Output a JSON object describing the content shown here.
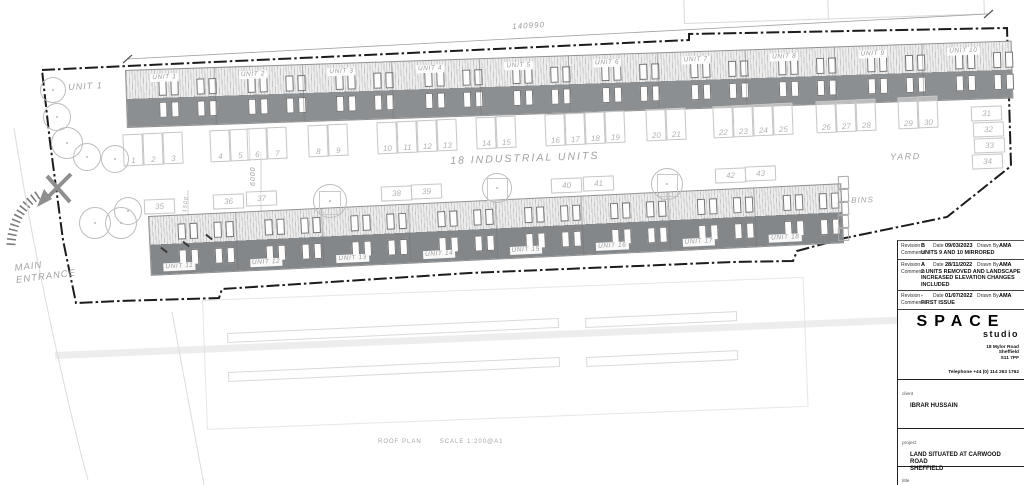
{
  "plan": {
    "overall_dimension": "140990",
    "road_dimension": "6000",
    "walkway_dimension": "1500",
    "area_label": "18 INDUSTRIAL UNITS",
    "unit1_area_label": "UNIT 1",
    "yard_label": "YARD",
    "bins_label": "BINS",
    "main_entrance_label": "MAIN\nENTRANCE",
    "caption": {
      "name": "ROOF PLAN",
      "scale": "SCALE 1:200@A1"
    },
    "top_row_units": [
      "UNIT 1",
      "UNIT 2",
      "UNIT 3",
      "UNIT 4",
      "UNIT 5",
      "UNIT 6",
      "UNIT 7",
      "UNIT 8",
      "UNIT 9",
      "UNIT 10"
    ],
    "bottom_row_units": [
      "UNIT 11",
      "UNIT 12",
      "UNIT 13",
      "UNIT 14",
      "UNIT 15",
      "UNIT 16",
      "UNIT 17",
      "UNIT 18"
    ],
    "parking_numbers_top": [
      "1",
      "2",
      "3",
      "4",
      "5",
      "6",
      "7",
      "8",
      "9",
      "10",
      "11",
      "12",
      "13",
      "14",
      "15",
      "16",
      "17",
      "18",
      "19",
      "20",
      "21",
      "22",
      "23",
      "24",
      "25",
      "26",
      "27",
      "28",
      "29",
      "30"
    ],
    "parking_numbers_side": [
      "31",
      "32",
      "33",
      "34"
    ],
    "parking_numbers_bottom": [
      "35",
      "36",
      "37",
      "38",
      "39",
      "40",
      "41",
      "42",
      "43"
    ]
  },
  "title_block": {
    "labels": {
      "revision": "Revision",
      "date": "Date",
      "drawn_by": "Drawn By",
      "comments": "Comments",
      "client": "client",
      "project": "project",
      "title": "title"
    },
    "revisions": [
      {
        "revision": "B",
        "date": "09/03/2023",
        "drawn_by": "AMA",
        "comments": "UNITS 9 AND 10 MIRRORED"
      },
      {
        "revision": "A",
        "date": "28/11/2022",
        "drawn_by": "AMA",
        "comments": "2 UNITS REMOVED AND LANDSCAPE\nINCREASED ELEVATION CHANGES INCLUDED"
      },
      {
        "revision": "-",
        "date": "01/07/2022",
        "drawn_by": "AMA",
        "comments": "FIRST ISSUE"
      }
    ],
    "studio": {
      "name": "SPACE",
      "subname": "studio",
      "address": "18 Mylor Road\nSheffield\nS11 7PF",
      "telephone": "Telephone +44 (0) 114 263 1762"
    },
    "client": "IBRAR HUSSAIN",
    "project": "LAND SITUATED AT CARWOOD ROAD\nSHEFFIELD",
    "drawing_title": "PROPOSED ROOF PLAN"
  },
  "colors": {
    "roof_light": "#ededed",
    "roof_dark": "#8c8f91",
    "boundary": "#1c1c1c",
    "cad_text": "#a2a2a2"
  }
}
